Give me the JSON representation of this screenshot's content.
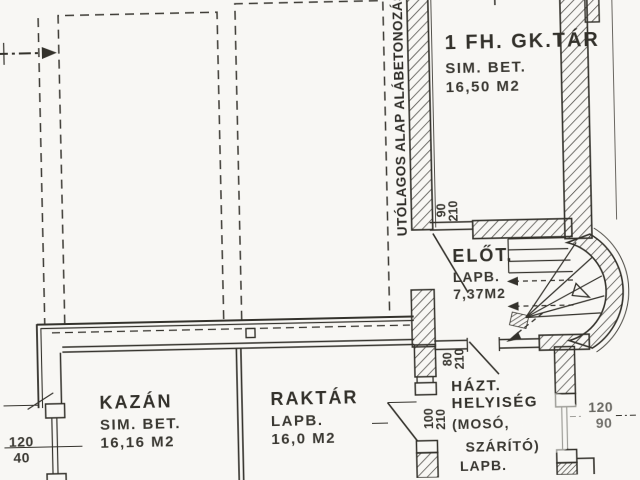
{
  "annotation": {
    "underpinning": "UTÓLAGOS ALAP ALÁBETONOZÁS"
  },
  "rooms": {
    "gktar": {
      "name": "1 FH. GK.TÁR",
      "finish": "SIM. BET.",
      "area": "16,50 M2"
    },
    "elot": {
      "name": "ELŐT.",
      "finish": "LAPB.",
      "area": "7,37M2"
    },
    "kazan": {
      "name": "KAZÁN",
      "finish": "SIM. BET.",
      "area": "16,16 M2"
    },
    "raktar": {
      "name": "RAKTÁR",
      "finish": "LAPB.",
      "area": "16,0 M2"
    },
    "haztartasi": {
      "name_line1": "HÁZT.",
      "name_line2": "HELYISÉG",
      "note_line1": "(MOSÓ,",
      "note_line2": "SZÁRÍTÓ)",
      "finish": "LAPB."
    }
  },
  "dimensions": {
    "left_window": {
      "top": "120",
      "bottom": "40"
    },
    "right_window": {
      "top": "120",
      "bottom": "90"
    },
    "door_elot_entry": {
      "top": "90",
      "bottom": "210"
    },
    "door_hazt_elot": {
      "top": "80",
      "bottom": "210"
    },
    "door_hazt_raktar": {
      "top": "100",
      "bottom": "210"
    }
  },
  "colors": {
    "ink": "#34322c",
    "paper": "#f8f7f4"
  }
}
